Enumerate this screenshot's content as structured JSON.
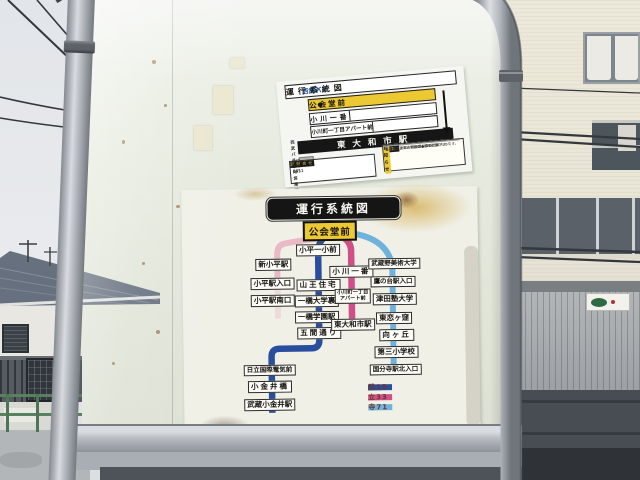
{
  "top_sign": {
    "operator": "西武バス",
    "title": "運行系統図",
    "current_stop": "公会堂前",
    "dot": "●",
    "next_stops": [
      "小川一番",
      "小川町一丁目アパート前"
    ],
    "terminal": "東大和市駅",
    "contact": {
      "header": "お問合せ",
      "rows": [
        {
          "name": "西武バス 立川営業所",
          "phone": "042-524-0851"
        },
        {
          "name": "西武バス 小平営業所",
          "phone": "042-342-3411"
        }
      ]
    },
    "notice": {
      "tag": "重要",
      "title": "お知らせ",
      "lines": [
        "この度、小平市公会堂工事のため",
        "乗り場変更は、裏面の●印をご覧下さい。",
        "この表は、2019年3月16日現在のものです。"
      ]
    }
  },
  "main_sign": {
    "title": "運行系統図",
    "current_stop": "公会堂前",
    "columns": {
      "branch": [
        "新小平駅",
        "小平駅入口",
        "小平駅南口"
      ],
      "mu19": [
        "小平一小前",
        "山王住宅",
        "一橋大学裏",
        "一橋学園駅",
        "五間通り",
        "日立国際電気前",
        "小金井橋",
        "武蔵小金井駅"
      ],
      "tachi33": [
        "小川一番",
        "小川町一丁目アパート前",
        "東大和市駅"
      ],
      "tera71": [
        "武蔵野美術大学",
        "鷹の台駅入口",
        "津田塾大学",
        "東恋ヶ窪",
        "向ヶ丘",
        "第三小学校",
        "国分寺駅北入口"
      ]
    },
    "legend": [
      {
        "label": "武19",
        "color": "#2a4e9e"
      },
      {
        "label": "立33",
        "color": "#d04f88"
      },
      {
        "label": "寺71",
        "color": "#6fb3dd"
      }
    ]
  }
}
